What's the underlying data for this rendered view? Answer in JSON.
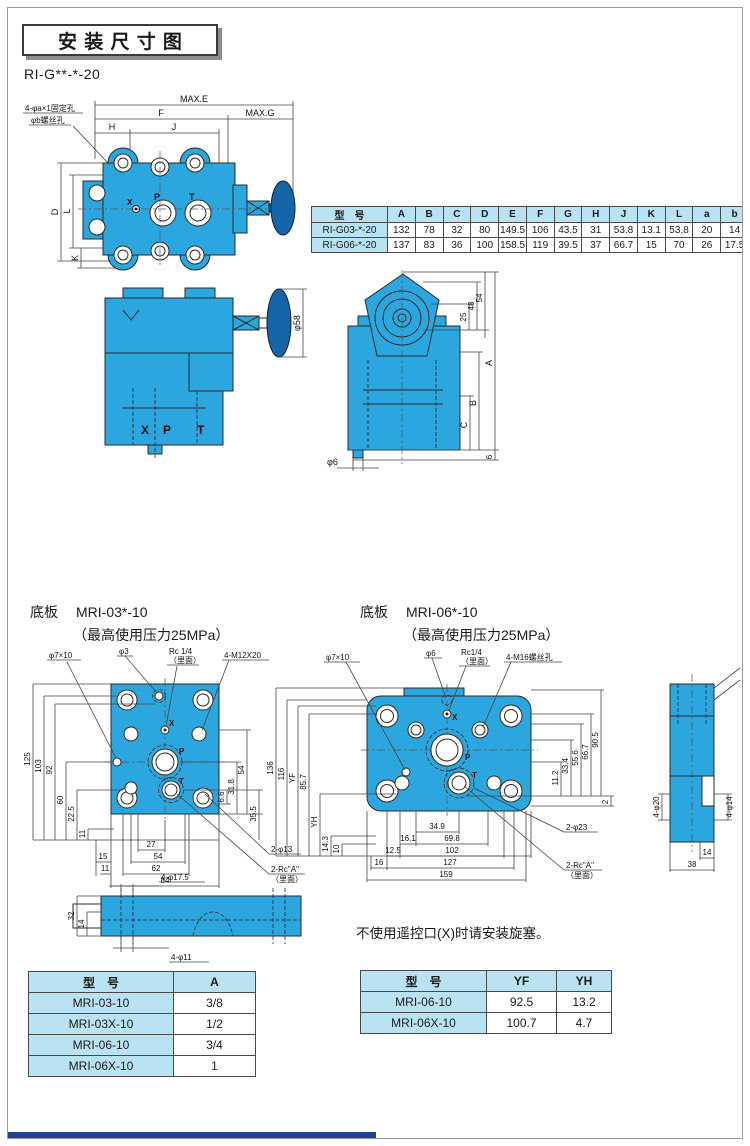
{
  "page": {
    "title": "安装尺寸图",
    "series_label": "RI-G**-*-20",
    "note": "不使用遥控口(X)时请安装旋塞。"
  },
  "plan_view": {
    "callout_fixing": "4-φa×1固定孔",
    "callout_screw": "φb螺丝孔",
    "dim_max_e": "MAX.E",
    "dim_f": "F",
    "dim_max_g": "MAX.G",
    "dim_h": "H",
    "dim_j": "J",
    "dim_d": "D",
    "dim_l": "L",
    "dim_k": "K",
    "port_x": "X",
    "port_p": "P",
    "port_t": "T"
  },
  "front_view": {
    "dim_phi58": "φ58",
    "port_x": "X",
    "port_p": "P",
    "port_t": "T"
  },
  "side_view": {
    "dim_25": "25",
    "dim_48": "48",
    "dim_54": "54",
    "dim_a": "A",
    "dim_b": "B",
    "dim_c": "C",
    "dim_6": "6",
    "dim_phi6": "φ6"
  },
  "dim_table": {
    "headers": [
      "型　号",
      "A",
      "B",
      "C",
      "D",
      "E",
      "F",
      "G",
      "H",
      "J",
      "K",
      "L",
      "a",
      "b"
    ],
    "rows": [
      [
        "RI-G03-*-20",
        "132",
        "78",
        "32",
        "80",
        "149.5",
        "106",
        "43.5",
        "31",
        "53.8",
        "13.1",
        "53.8",
        "20",
        "14"
      ],
      [
        "RI-G06-*-20",
        "137",
        "83",
        "36",
        "100",
        "158.5",
        "119",
        "39.5",
        "37",
        "66.7",
        "15",
        "70",
        "26",
        "17.5"
      ]
    ]
  },
  "mri03": {
    "section_label": "底板",
    "model": "MRI-03*-10",
    "pressure_note": "（最高使用压力25MPa）",
    "callout_phi7x10": "φ7×10",
    "callout_phi3": "φ3",
    "callout_rc": "Rc 1/4",
    "callout_rc_sub": "（里面）",
    "callout_m12": "4-M12X20",
    "callout_2phi13": "2-φ13",
    "callout_2rc": "2-Rc\"A\"",
    "callout_2rc_sub": "（里面）",
    "port_x": "X",
    "port_p": "P",
    "port_t": "T",
    "dims_left": [
      "125",
      "103",
      "92",
      "60",
      "22.5",
      "11"
    ],
    "dims_right": [
      "6.6",
      "31.8",
      "54",
      "35.5"
    ],
    "dims_bottom": [
      "27",
      "15",
      "54",
      "11",
      "62",
      "84"
    ],
    "side_view": {
      "dim_top": "4-φ17.5",
      "dim_bottom": "4-φ11",
      "dim_32": "32",
      "dim_14": "14"
    }
  },
  "mri06": {
    "section_label": "底板",
    "model": "MRI-06*-10",
    "pressure_note": "（最高使用压力25MPa）",
    "callout_phi7x10": "φ7×10",
    "callout_phi6": "φ6",
    "callout_rc": "Rc1/4",
    "callout_rc_sub": "（里面）",
    "callout_m16": "4-M16螺丝孔",
    "callout_2phi23": "2-φ23",
    "callout_2rc": "2-Rc\"A\"",
    "callout_2rc_sub": "（里面）",
    "port_x": "X",
    "port_p": "P",
    "port_t": "T",
    "dims_left": [
      "136",
      "116",
      "YF",
      "85.7",
      "YH",
      "14.3",
      "10"
    ],
    "dims_right": [
      "11.2",
      "33.4",
      "55.6",
      "66.7",
      "90.5",
      "2"
    ],
    "dims_bottom": [
      "34.9",
      "16.1",
      "69.8",
      "12.5",
      "102",
      "16",
      "127",
      "159"
    ],
    "side_view": {
      "dim_4phi20": "4-φ20",
      "dim_4phi14": "4-φ14",
      "dim_14": "14",
      "dim_38": "38"
    }
  },
  "a_table": {
    "headers": [
      "型　号",
      "A"
    ],
    "rows": [
      [
        "MRI-03-10",
        "3/8"
      ],
      [
        "MRI-03X-10",
        "1/2"
      ],
      [
        "MRI-06-10",
        "3/4"
      ],
      [
        "MRI-06X-10",
        "1"
      ]
    ]
  },
  "yf_table": {
    "headers": [
      "型　号",
      "YF",
      "YH"
    ],
    "rows": [
      [
        "MRI-06-10",
        "92.5",
        "13.2"
      ],
      [
        "MRI-06X-10",
        "100.7",
        "4.7"
      ]
    ]
  }
}
